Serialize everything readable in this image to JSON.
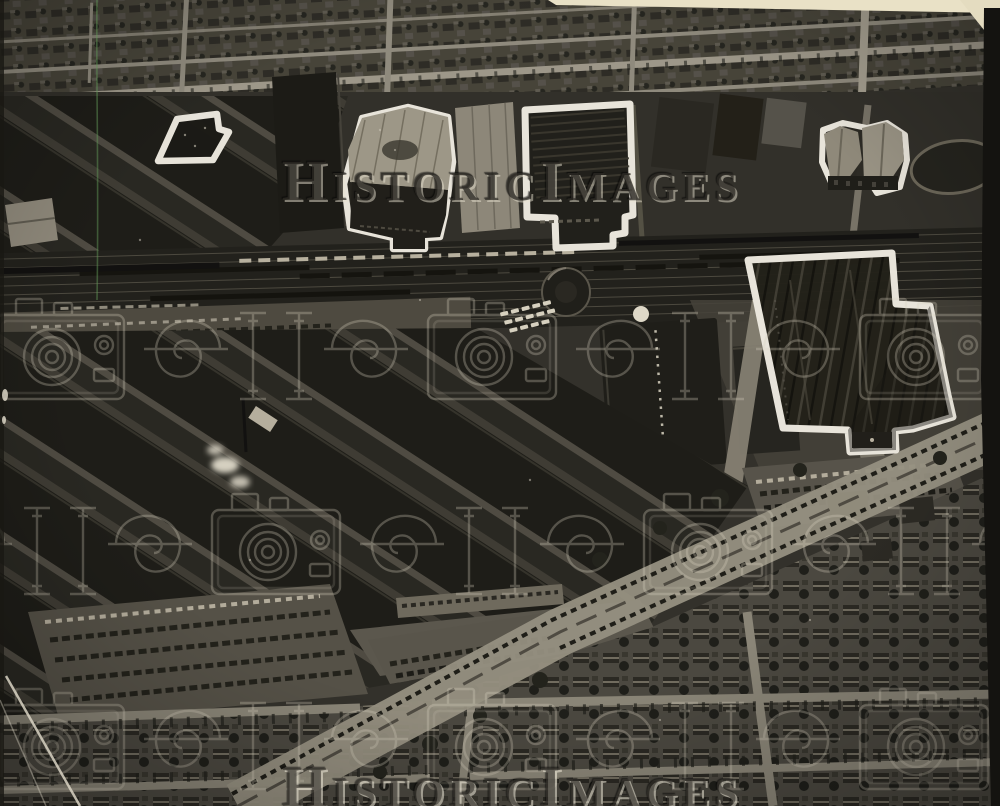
{
  "photo": {
    "kind": "black-and-white aerial press photograph",
    "scene": "industrial district seen from the air: railroad yard across the middle, factory sheds and smokestack lower left, diagonal boulevard with parked cars, residential street grids top and bottom",
    "outlined_building_count": 5
  },
  "watermark": {
    "text": "HistoricImages",
    "logo_icon": "historicimages-camera-logo"
  },
  "artifacts": {
    "top_edge": "cream paper strip",
    "right_edge": "dark torn border",
    "upper_left": "green vertical scratch",
    "lower_left": "white crease line"
  },
  "colors": {
    "photo_dark": "#1f1e19",
    "photo_mid": "#47443c",
    "photo_light": "#968f80",
    "outline_white": "#eeeae0",
    "paper_cream": "#e9e1c6",
    "edge_black": "#141310",
    "scratch_green": "#5a9650",
    "watermark_tint": "#d8d2c0"
  }
}
